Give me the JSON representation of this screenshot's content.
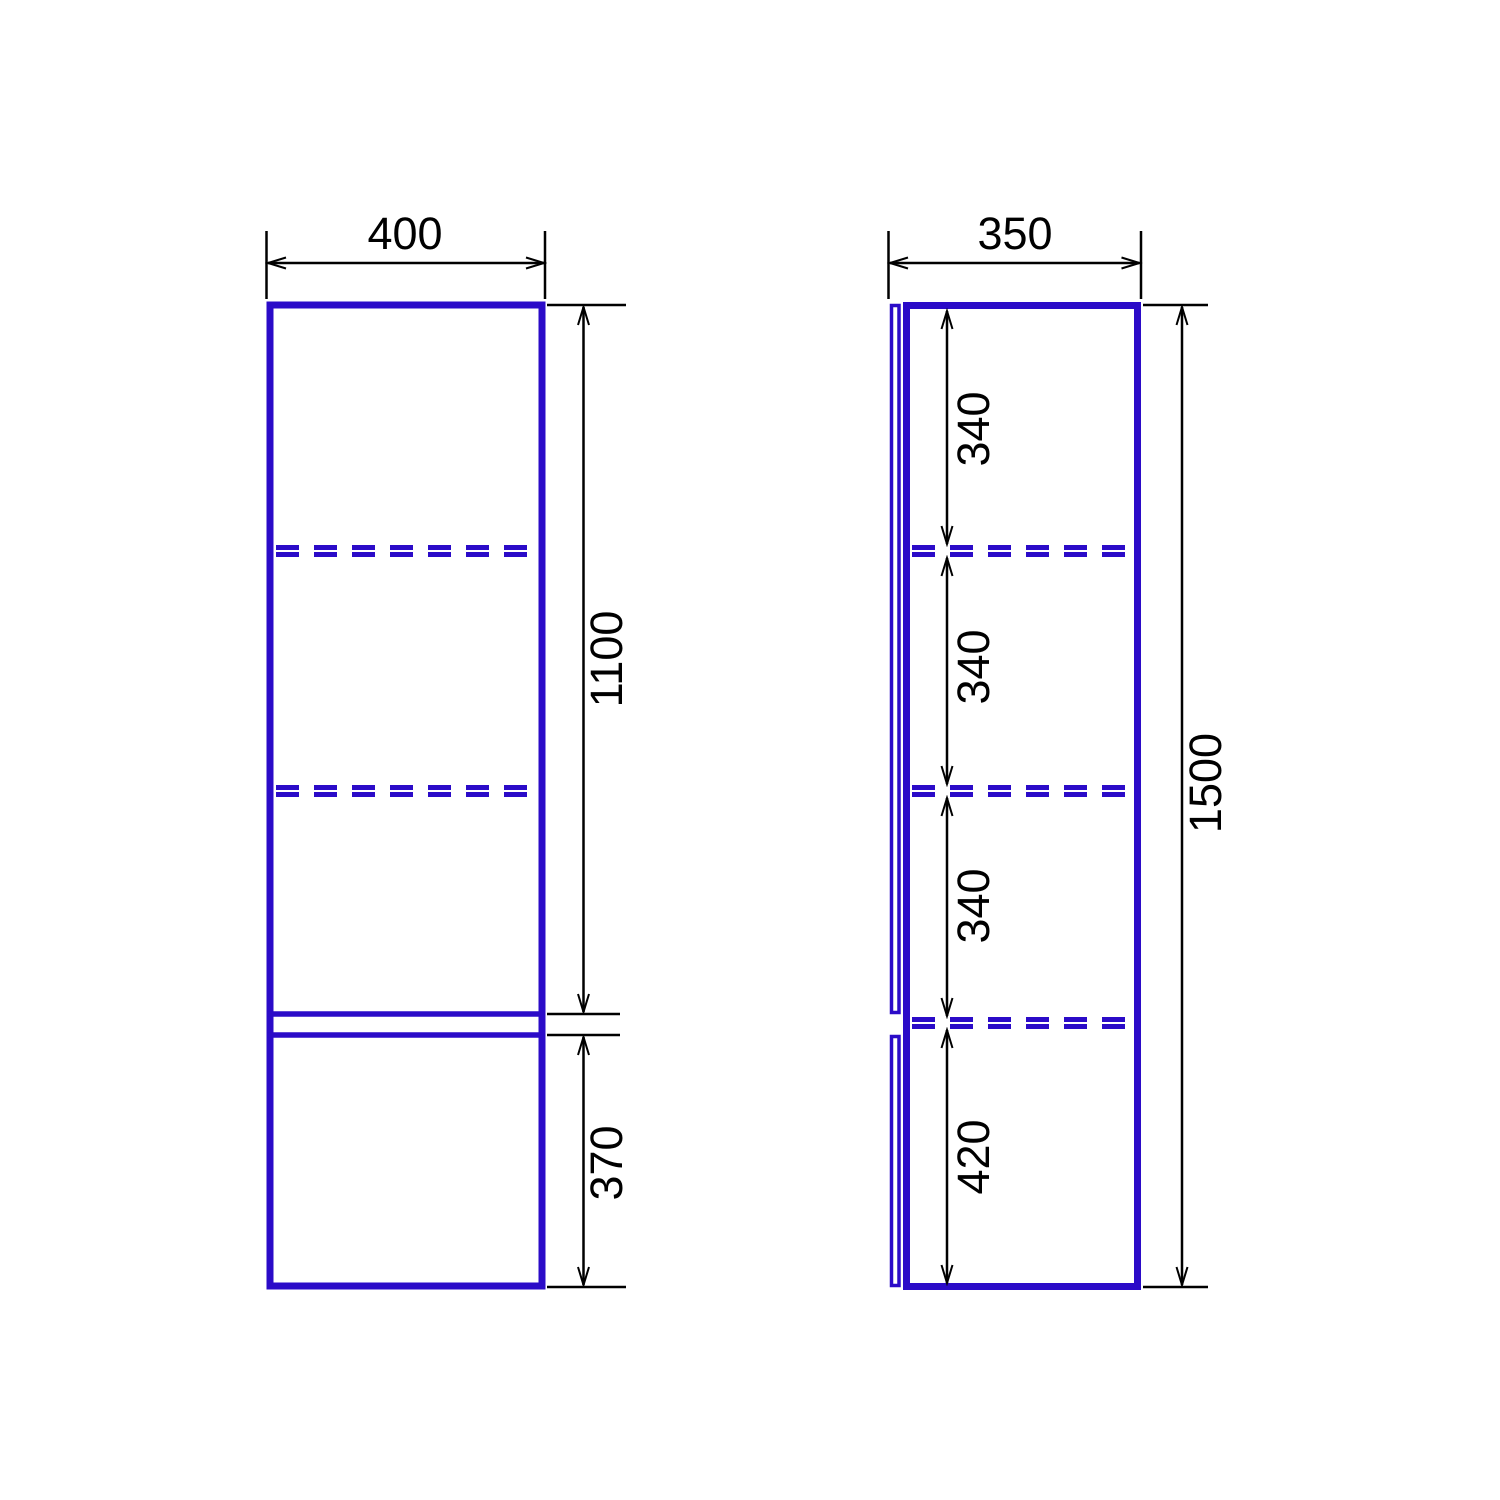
{
  "drawing_type": "cabinet-technical-drawing-two-views",
  "colors": {
    "cabinet_outline": "#2B0BC8",
    "dimension_lines": "#000000",
    "background": "#FFFFFF"
  },
  "front_view": {
    "width_mm": "400",
    "upper_height_mm": "1100",
    "lower_height_mm": "370",
    "shelf_count_dashed": 2
  },
  "side_view": {
    "depth_mm": "350",
    "total_height_mm": "1500",
    "sections_mm": [
      "340",
      "340",
      "340",
      "420"
    ],
    "shelf_count_dashed": 3
  }
}
